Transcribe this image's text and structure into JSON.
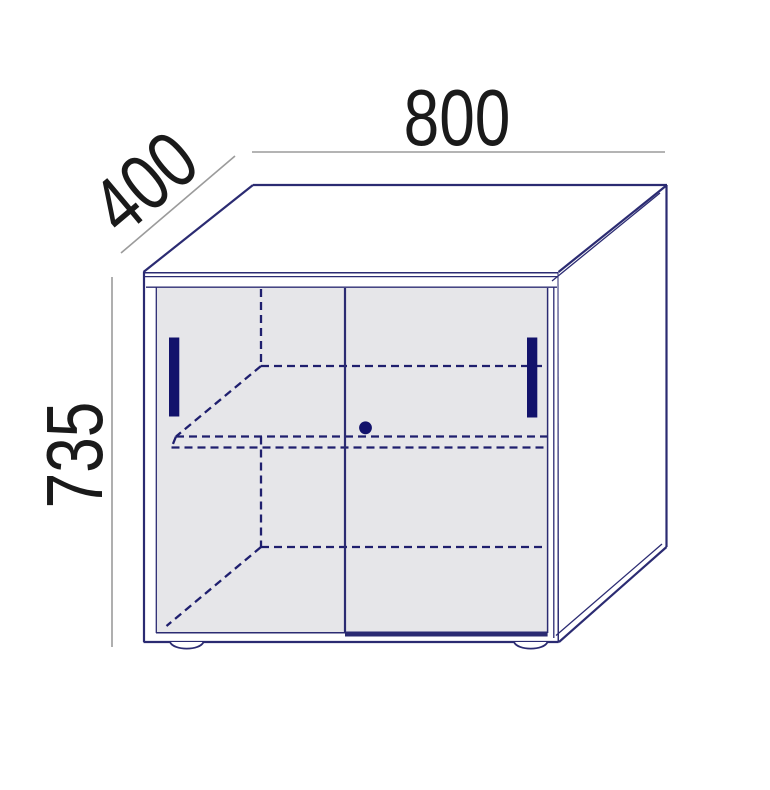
{
  "drawing": {
    "kind": "furniture-dimension-diagram",
    "dimensions": {
      "width_label": "800",
      "depth_label": "400",
      "height_label": "735"
    },
    "colors": {
      "outline": "#2b2b72",
      "hidden_line": "#1f1f6e",
      "hardware": "#12126b",
      "door_fill": "#e6e6e9",
      "side_fill": "#ffffff",
      "dimension_line": "#9b9b9b",
      "label_text": "#1a1a1a",
      "background": "#ffffff"
    },
    "parts": [
      "top-panel",
      "right-side-panel",
      "left-sliding-door",
      "right-sliding-door",
      "door-handle-left",
      "door-handle-right",
      "lock-knob",
      "hidden-shelf-lines",
      "plinth-foot-left",
      "plinth-foot-right"
    ]
  }
}
